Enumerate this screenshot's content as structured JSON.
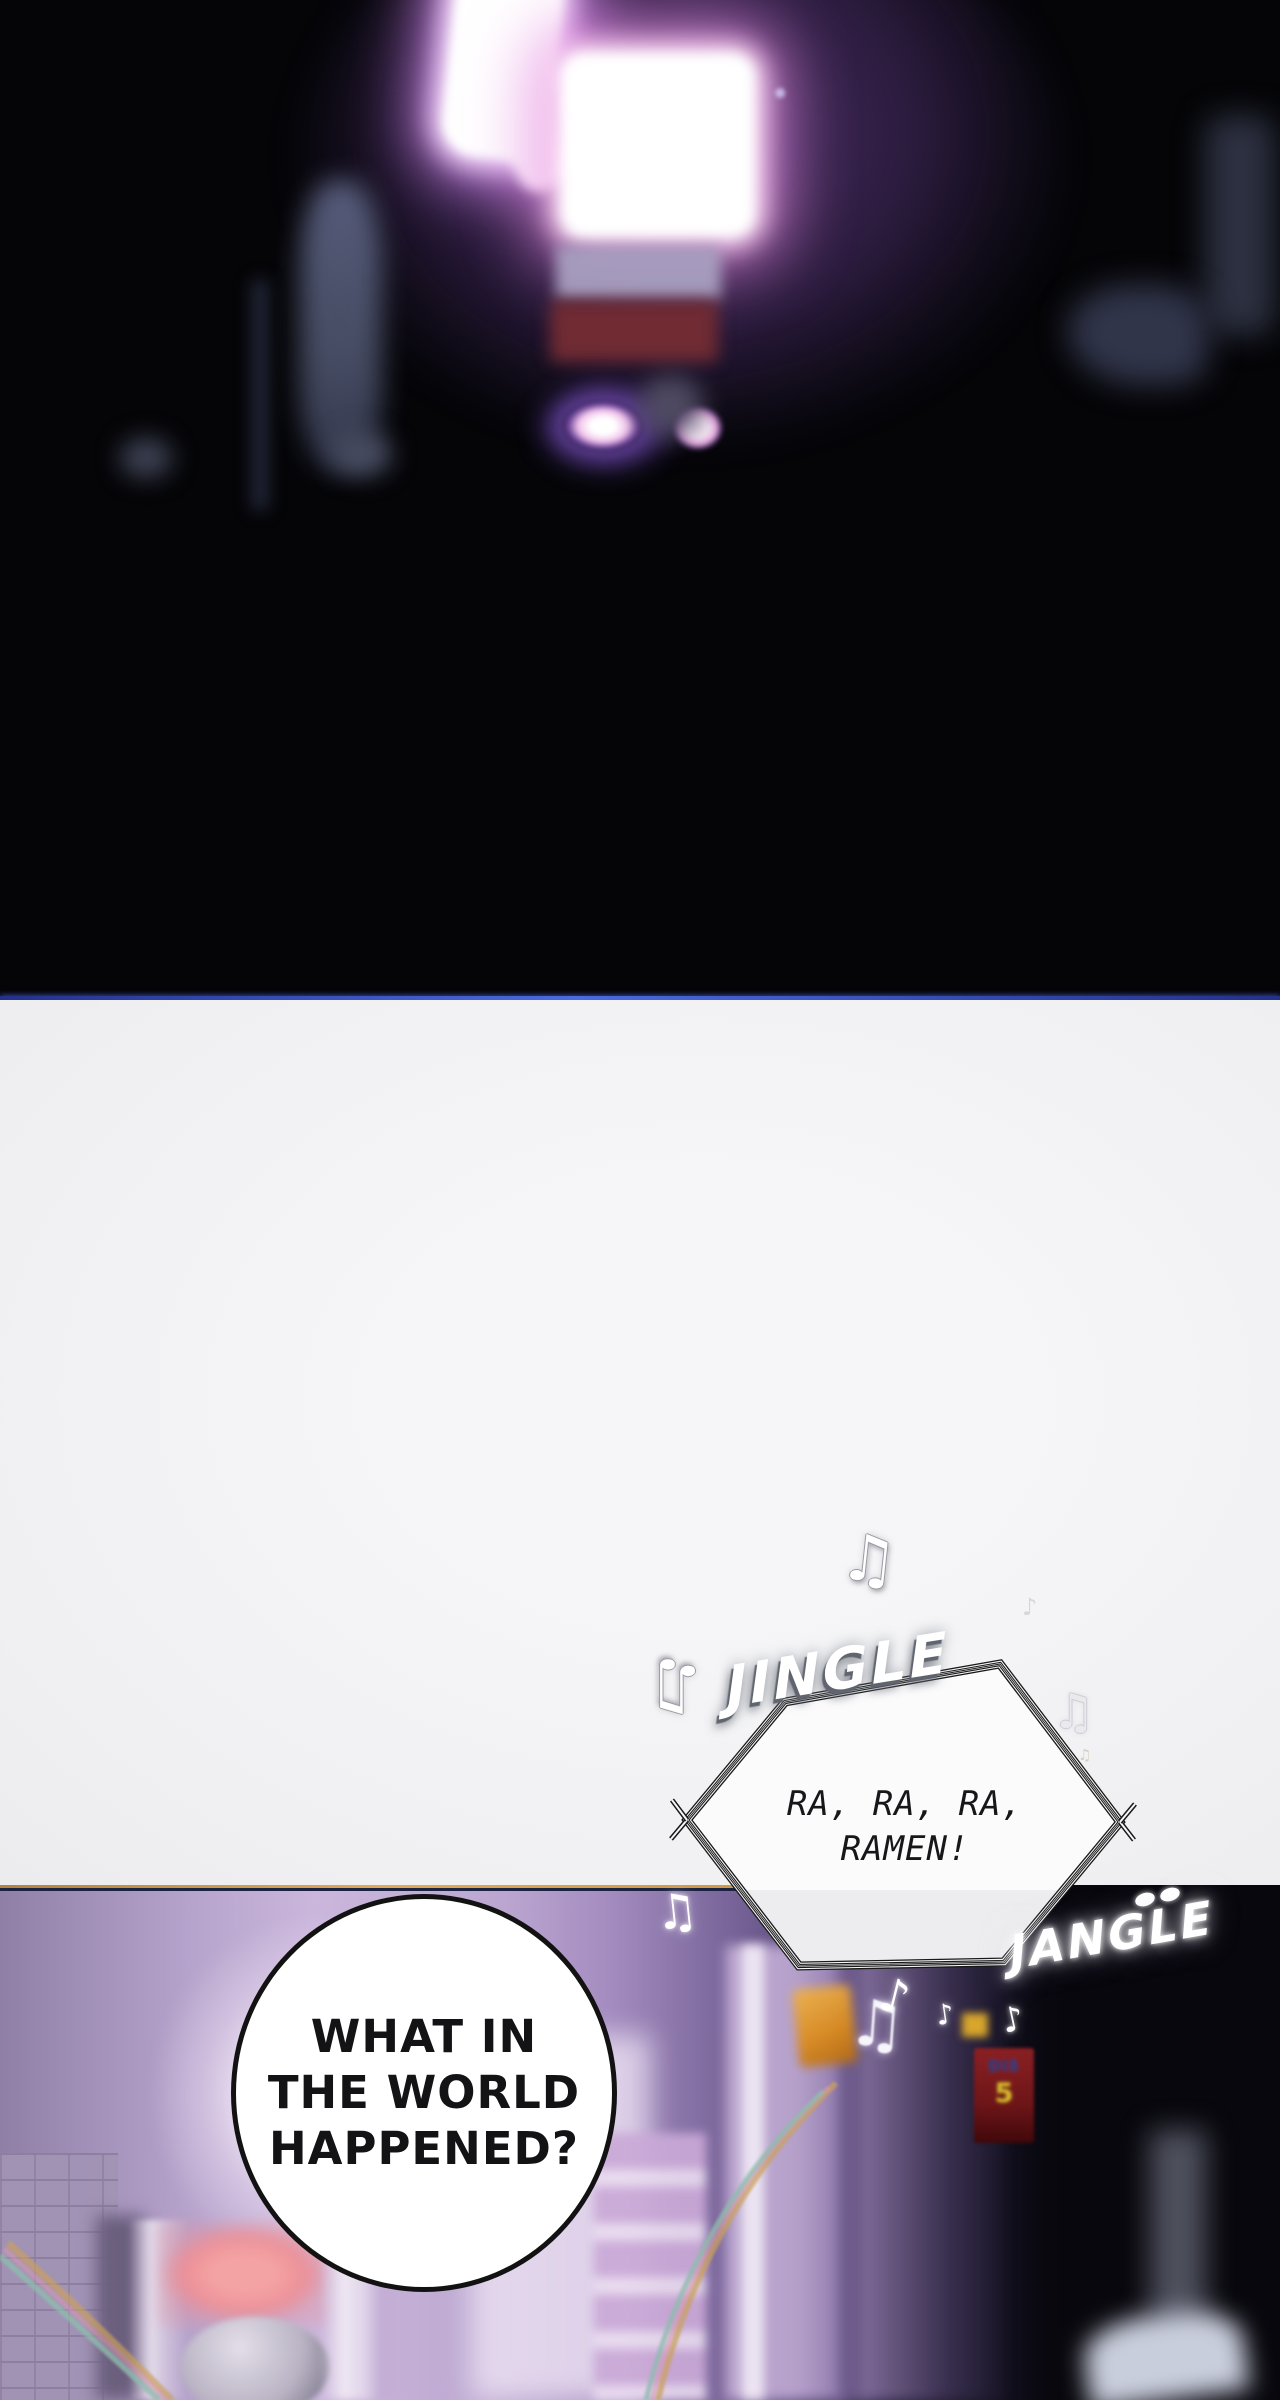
{
  "page": {
    "kind": "webtoon-comic-page"
  },
  "sfx": {
    "jingle": "JINGLE",
    "jangle": "JANGLE"
  },
  "speech": {
    "hexagon_bubble": {
      "line1": "RA, RA, RA,",
      "line2": "RAMEN!"
    },
    "circle_bubble": {
      "line1": "WHAT IN",
      "line2": "THE WORLD",
      "line3": "HAPPENED?"
    }
  },
  "signs": {
    "red_sign": {
      "text": "DIS",
      "number": "5"
    }
  },
  "glyphs": {
    "beamed_note": "♫",
    "eighth_note": "♪"
  },
  "colors": {
    "top_panel_bg": "#050508",
    "gutter_bg": "#f2f2f4",
    "neon_glow": "#d88cf0",
    "divider_blue": "#4a6ae0",
    "divider_orange": "#d6953f",
    "bottom_panel_purple": "#bba6d0",
    "salmon_sign": "#f0989c",
    "red_sign": "#7d1d20",
    "orange_sign": "#e8a23c",
    "bubble_fill": "#ffffff",
    "bubble_stroke": "#121212"
  }
}
